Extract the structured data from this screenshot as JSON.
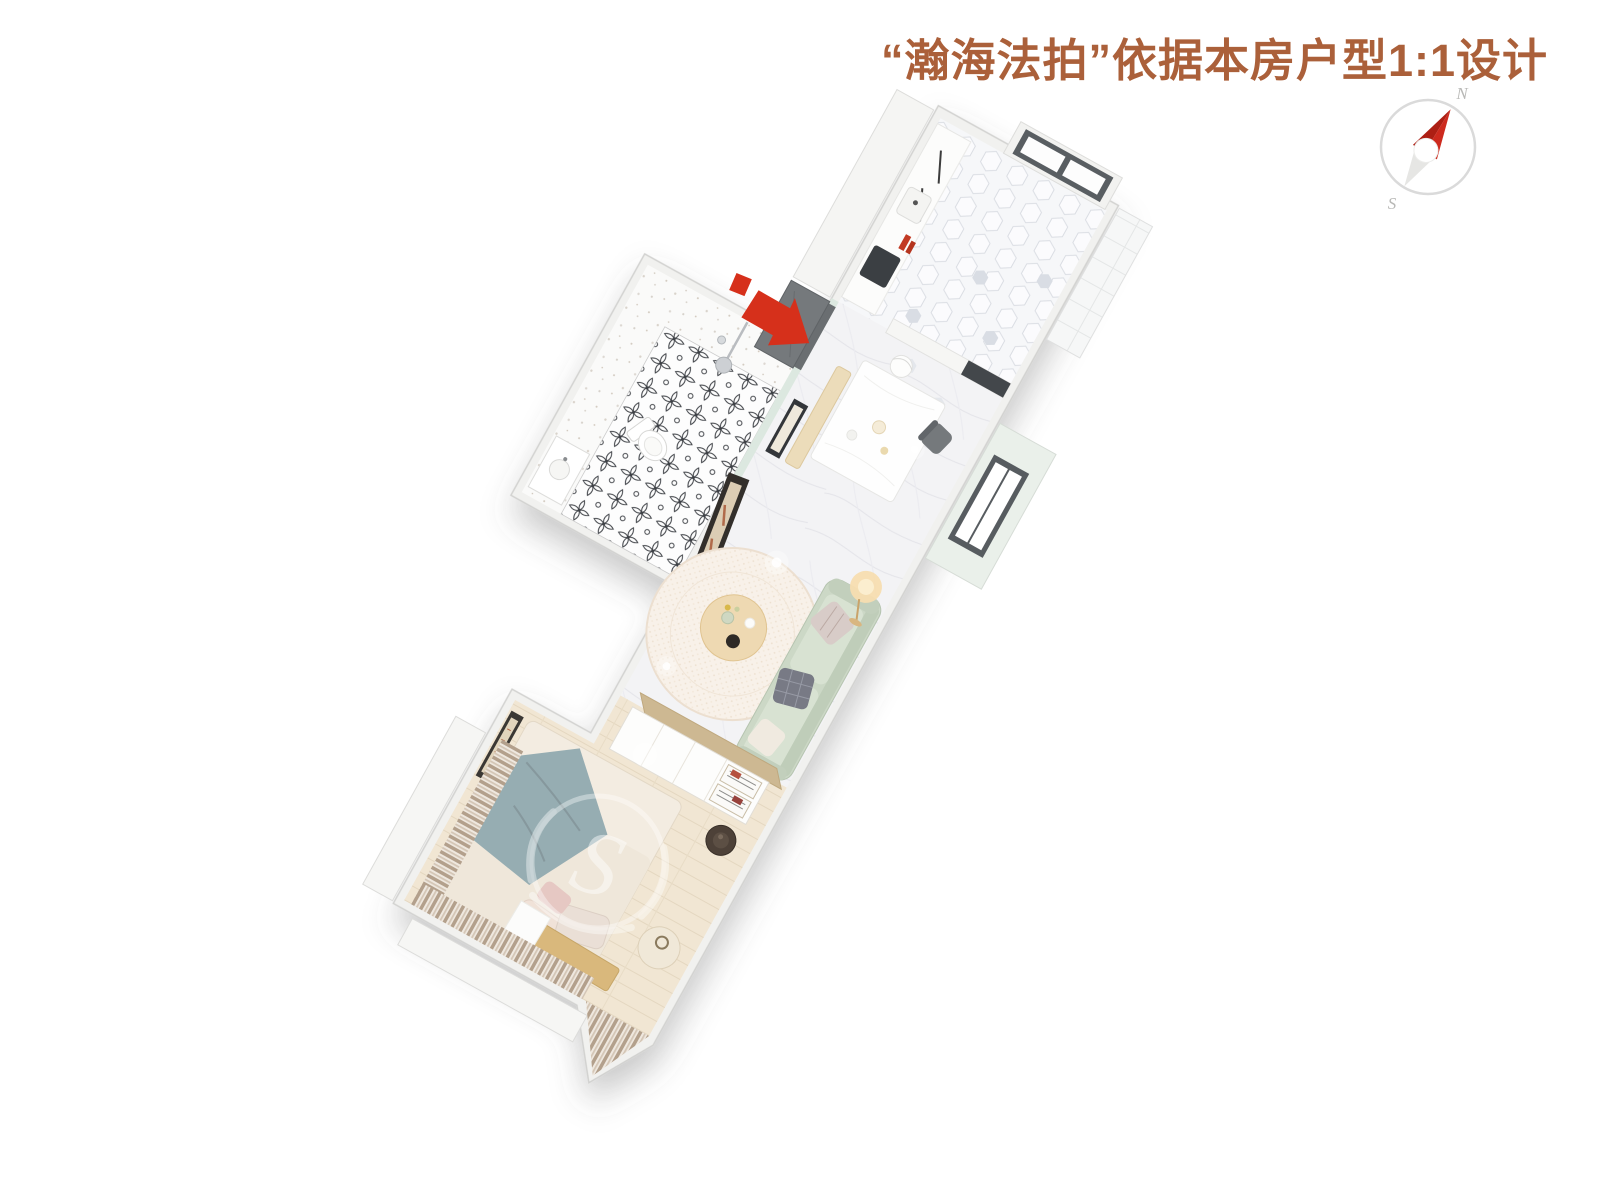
{
  "title": {
    "text": "“瀚海法拍”依据本房户型1:1设计",
    "color": "#ab603a"
  },
  "compass": {
    "north": "N",
    "south": "S",
    "needle_color": "#cd2a1e",
    "needle_dark_color": "#ad1f14",
    "tail_color": "#e6e6e4",
    "ring_color": "#dadada"
  },
  "entrance": {
    "arrow_color": "#d6301b",
    "meaning": "entrance-direction"
  },
  "watermark": {
    "glyph": "S"
  },
  "floorplan": {
    "rotation_deg": 29,
    "rooms": [
      {
        "name": "kitchen",
        "floor": "hex-tile"
      },
      {
        "name": "dining-area",
        "floor": "marble"
      },
      {
        "name": "bathroom",
        "floor": "patterned-tile"
      },
      {
        "name": "living-room",
        "floor": "marble"
      },
      {
        "name": "bedroom",
        "floor": "wood-plank"
      }
    ],
    "furniture": [
      "kitchen-cabinets",
      "kitchen-window",
      "side-window",
      "entrance-door",
      "dining-table",
      "dining-bench",
      "dining-chairs",
      "pendant-light",
      "wall-picture",
      "shower",
      "toilet",
      "washbasin",
      "leaning-mirror",
      "area-rug",
      "coffee-table",
      "floor-lamp",
      "sofa",
      "wardrobe",
      "bed",
      "bedside-stool",
      "round-side-table",
      "bedroom-art",
      "wooden-bench",
      "curtains"
    ],
    "palette": {
      "wall": "#f1f1ef",
      "mint_wall": "#dce8e0",
      "marble_floor": "#f3f3f5",
      "wood_floor": "#f1e6d3",
      "sofa": "#ccd8c6",
      "rug": "#f8f1e9",
      "bed_throw": "#96adb2",
      "curtain": "#b3a08c",
      "wardrobe_top": "#cdb892",
      "window_frame": "#595e62",
      "door": "#75797c"
    }
  }
}
